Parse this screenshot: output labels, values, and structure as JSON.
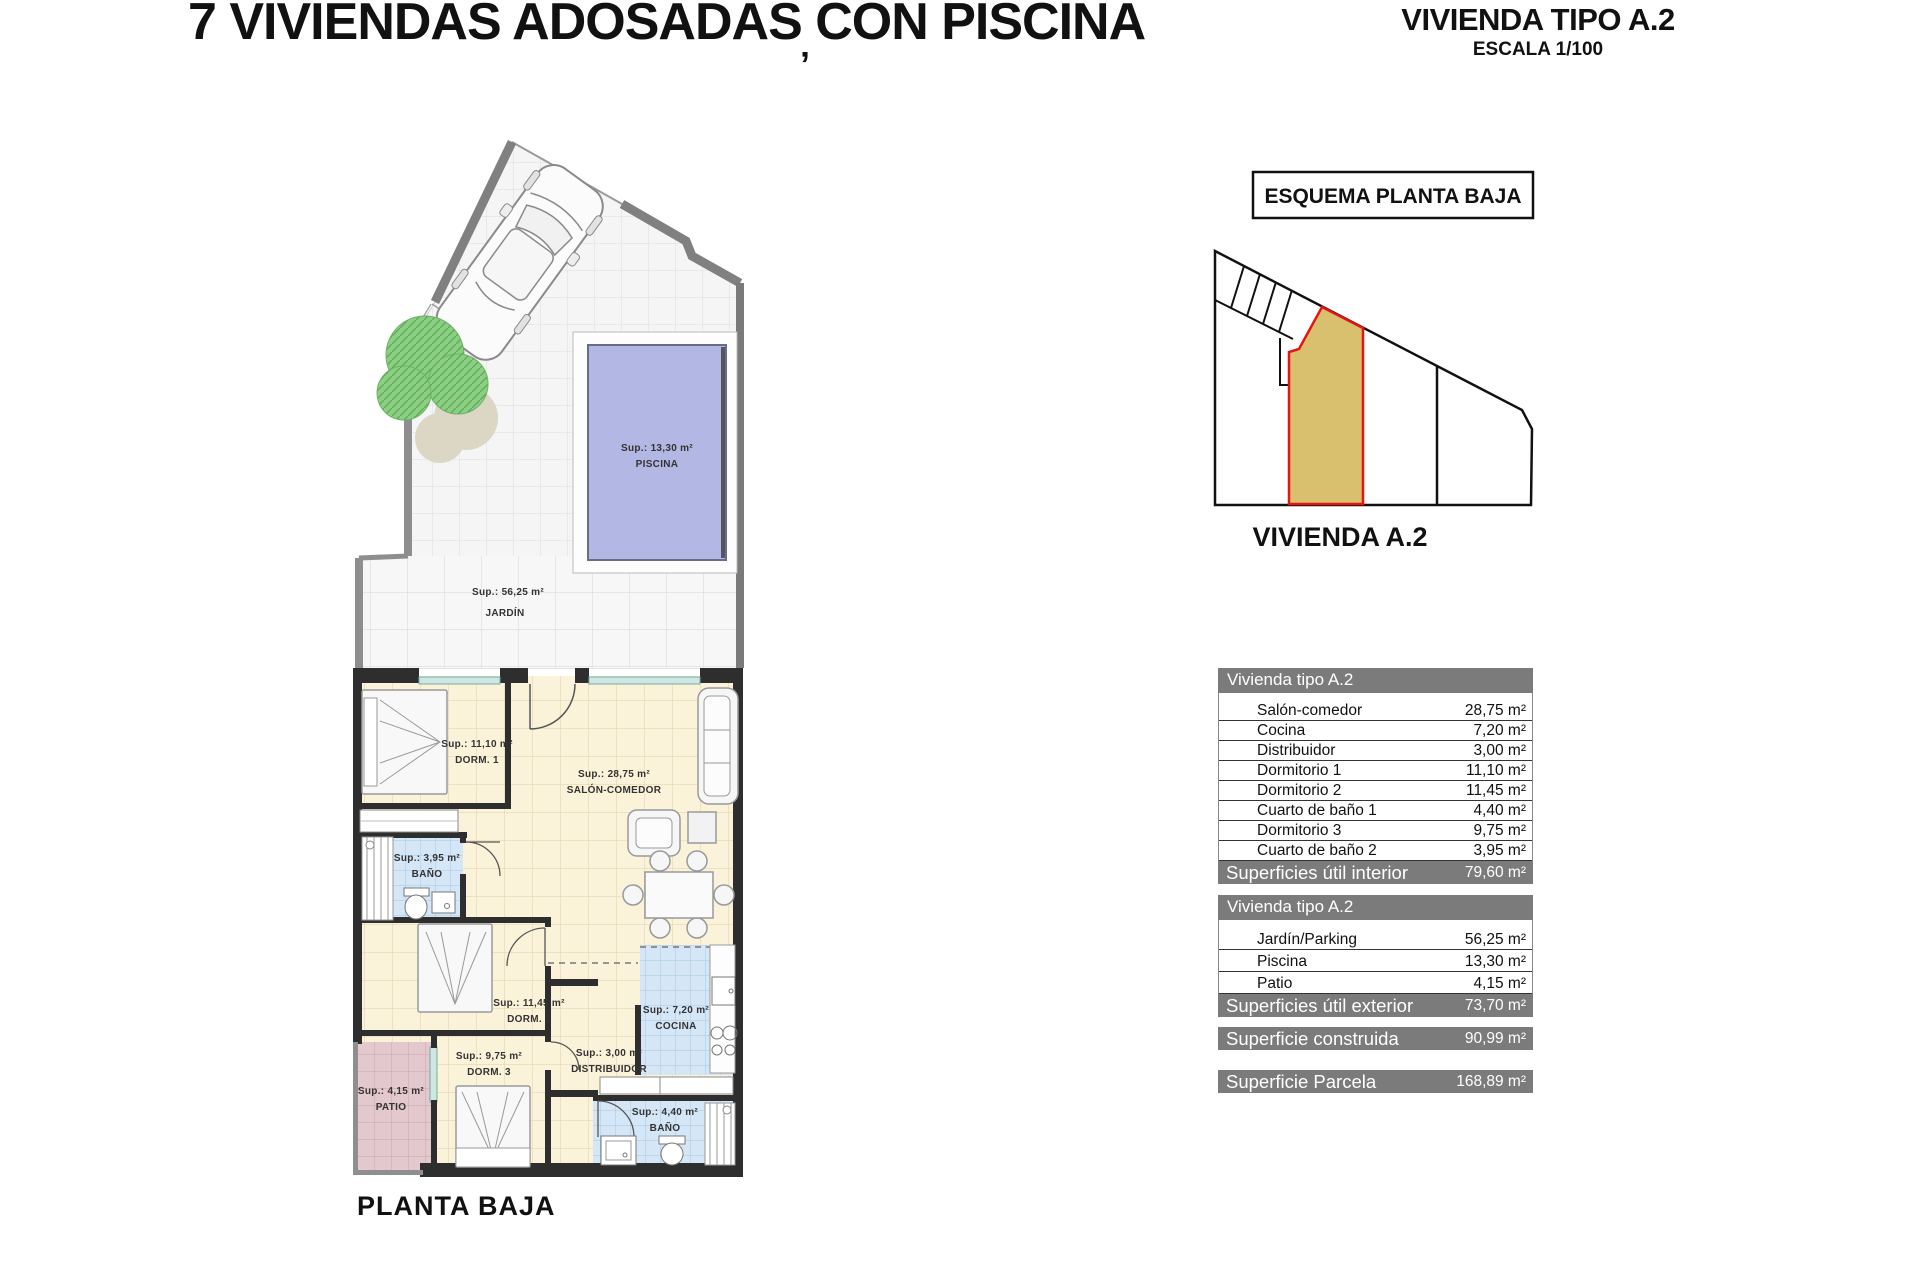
{
  "header": {
    "title": "7 VIVIENDAS ADOSADAS CON PISCINA",
    "stray_mark": "’",
    "right_title": "VIVIENDA TIPO A.2",
    "scale": "ESCALA 1/100"
  },
  "schema": {
    "box_label": "ESQUEMA PLANTA BAJA",
    "unit_label": "VIVIENDA A.2",
    "highlight_color": "#d9c06e",
    "outline_color": "#e81313"
  },
  "plan": {
    "caption": "PLANTA BAJA",
    "rooms": [
      {
        "id": "piscina",
        "sup": "Sup.: 13,30 m²",
        "name": "PISCINA"
      },
      {
        "id": "jardin",
        "sup": "Sup.: 56,25 m²",
        "name": "JARDÍN"
      },
      {
        "id": "dorm1",
        "sup": "Sup.: 11,10 m²",
        "name": "DORM. 1"
      },
      {
        "id": "salon",
        "sup": "Sup.: 28,75 m²",
        "name": "SALÓN-COMEDOR"
      },
      {
        "id": "bano1",
        "sup": "Sup.: 3,95 m²",
        "name": "BAÑO"
      },
      {
        "id": "dorm2",
        "sup": "Sup.: 11,45 m²",
        "name": "DORM. 2"
      },
      {
        "id": "cocina",
        "sup": "Sup.: 7,20 m²",
        "name": "COCINA"
      },
      {
        "id": "dorm3",
        "sup": "Sup.: 9,75 m²",
        "name": "DORM. 3"
      },
      {
        "id": "distribuidor",
        "sup": "Sup.: 3,00 m²",
        "name": "DISTRIBUIDOR"
      },
      {
        "id": "patio",
        "sup": "Sup.: 4,15 m²",
        "name": "PATIO"
      },
      {
        "id": "bano2",
        "sup": "Sup.: 4,40 m²",
        "name": "BAÑO"
      }
    ]
  },
  "tables": {
    "interior": {
      "header": "Vivienda tipo A.2",
      "rows": [
        {
          "label": "Salón-comedor",
          "value": "28,75 m²"
        },
        {
          "label": "Cocina",
          "value": "7,20 m²"
        },
        {
          "label": "Distribuidor",
          "value": "3,00 m²"
        },
        {
          "label": "Dormitorio 1",
          "value": "11,10 m²"
        },
        {
          "label": "Dormitorio 2",
          "value": "11,45 m²"
        },
        {
          "label": "Cuarto de baño 1",
          "value": "4,40 m²"
        },
        {
          "label": "Dormitorio 3",
          "value": "9,75 m²"
        },
        {
          "label": "Cuarto de baño 2",
          "value": "3,95 m²"
        }
      ],
      "footer_label": "Superficies útil interior",
      "footer_value": "79,60 m²"
    },
    "exterior": {
      "header": "Vivienda tipo A.2",
      "rows": [
        {
          "label": "Jardín/Parking",
          "value": "56,25 m²"
        },
        {
          "label": "Piscina",
          "value": "13,30 m²"
        },
        {
          "label": "Patio",
          "value": "4,15 m²"
        }
      ],
      "footer_label": "Superficies útil exterior",
      "footer_value": "73,70 m²"
    },
    "construida": {
      "label": "Superficie construida",
      "value": "90,99 m²"
    },
    "parcela": {
      "label": "Superficie Parcela",
      "value": "168,89 m²"
    }
  }
}
